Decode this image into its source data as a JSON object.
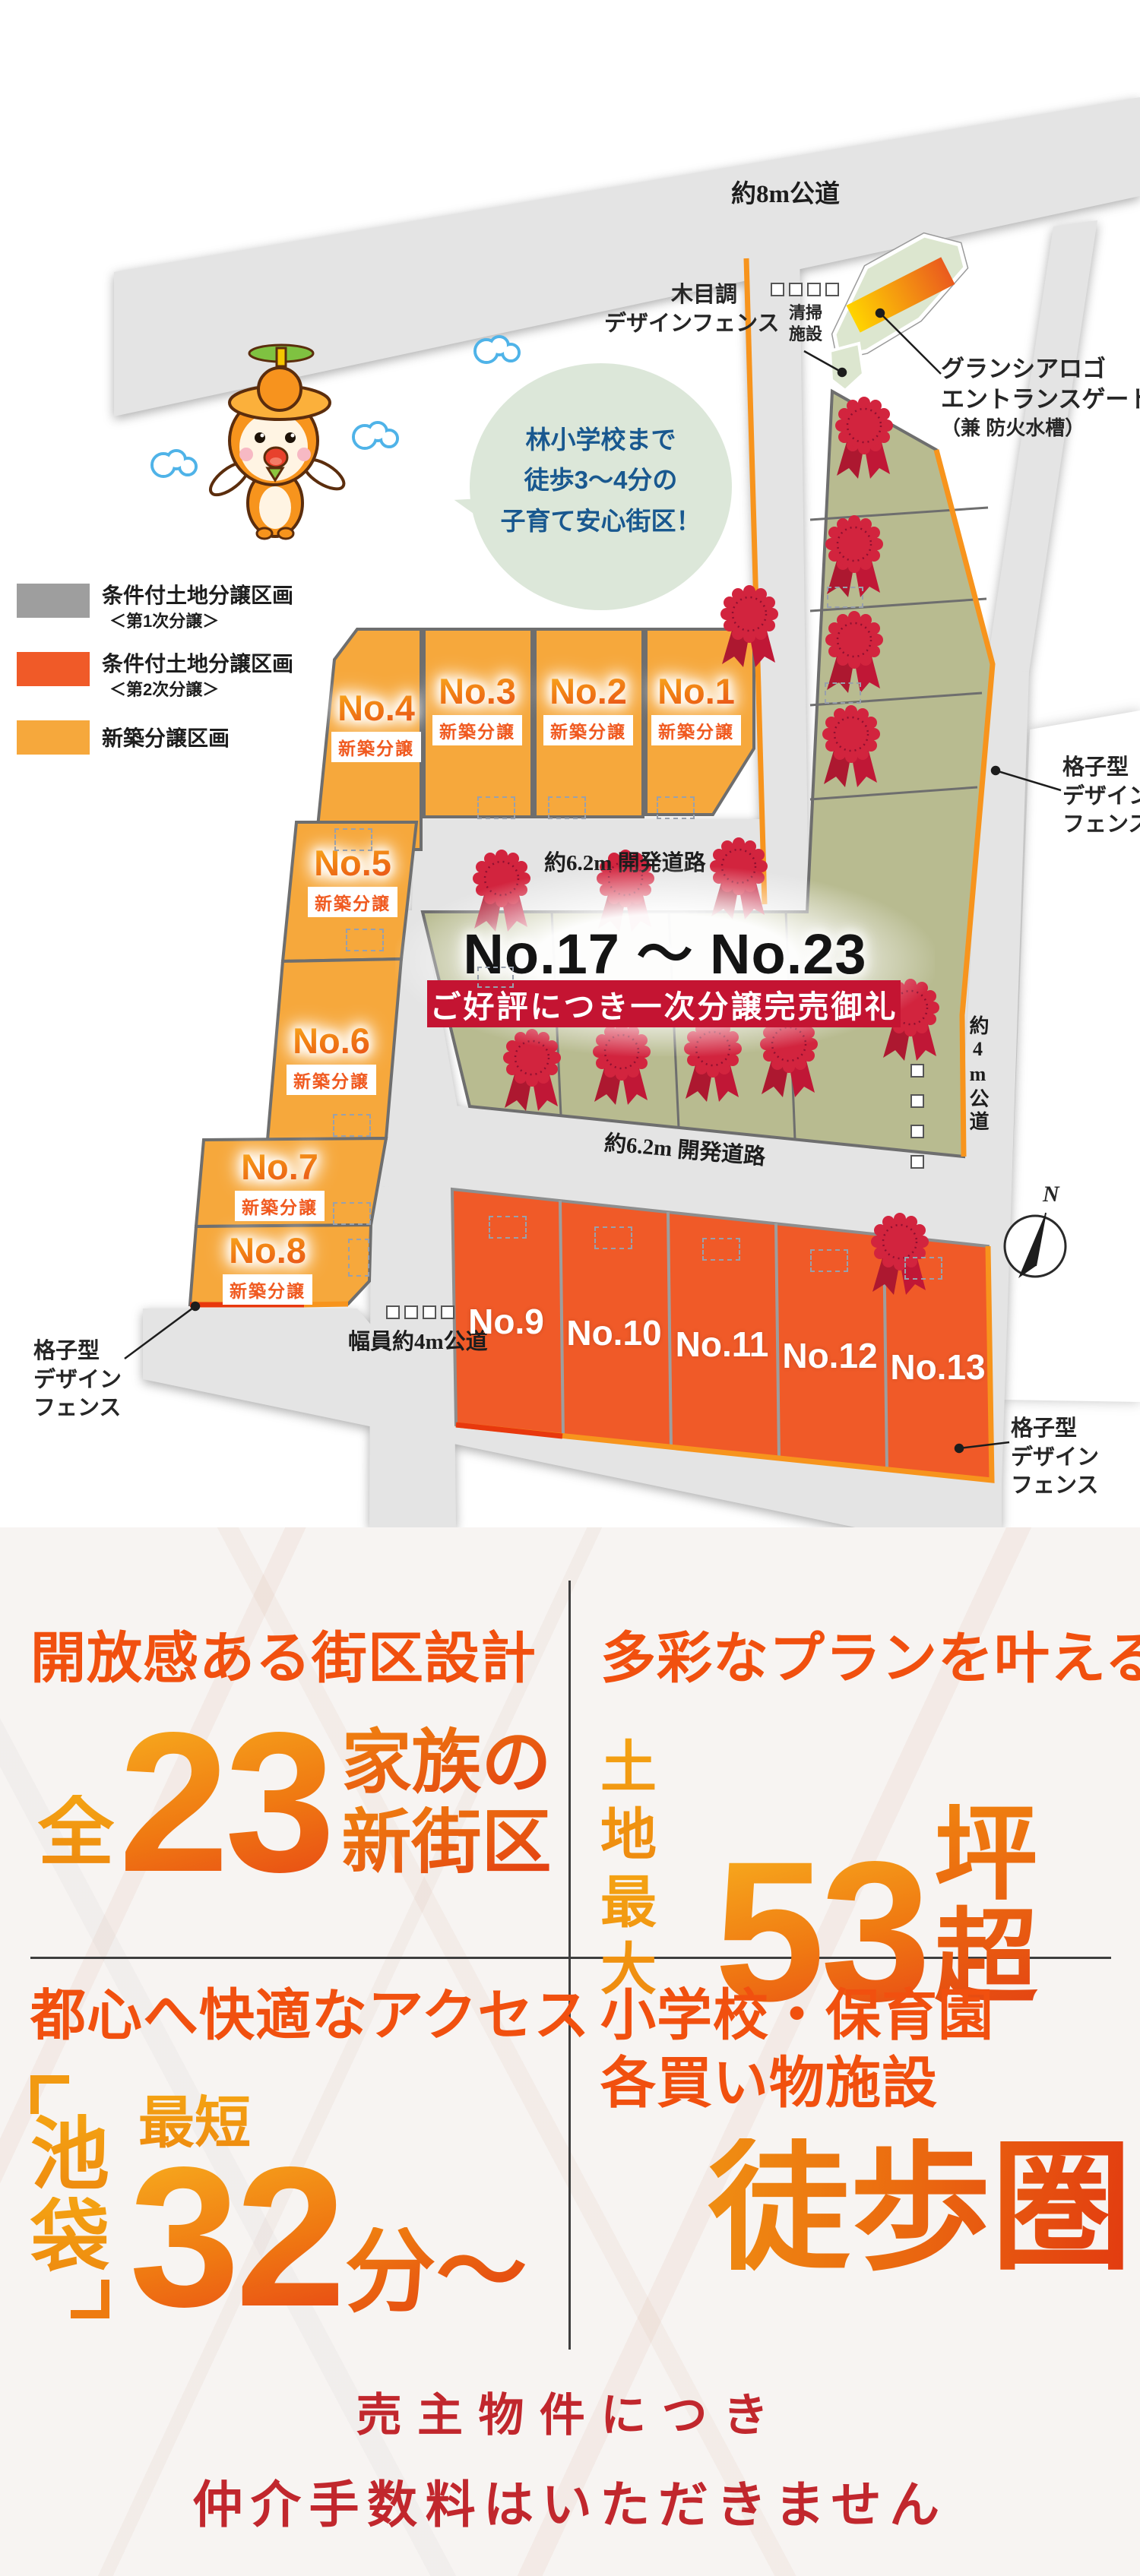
{
  "map": {
    "road_labels": {
      "top": "約8m公道",
      "dev1": "約6.2m 開発道路",
      "dev2": "約6.2m 開発道路",
      "south": "幅員約4m公道",
      "east": "約4m公道"
    },
    "bubble": {
      "line1": "林小学校まで",
      "line2": "徒歩3～4分の",
      "line3": "子育て安心街区！"
    },
    "legend": [
      {
        "label": "条件付土地分譲区画",
        "sub": "＜第1次分譲＞",
        "color": "#9E9E9E"
      },
      {
        "label": "条件付土地分譲区画",
        "sub": "＜第2次分譲＞",
        "color": "#F05A28"
      },
      {
        "label": "新築分譲区画",
        "sub": "",
        "color": "#F6A83C"
      }
    ],
    "annotations": {
      "wood1": "木目調",
      "wood2": "デザインフェンス",
      "cleaning1": "清掃",
      "cleaning2": "施設",
      "gate1": "グランシアロゴ",
      "gate2": "エントランスゲート",
      "gate3": "（兼 防火水槽）",
      "lattice1": "格子型",
      "lattice2": "デザイン",
      "lattice3": "フェンス",
      "compass": "N"
    },
    "sold": {
      "range": "No.17 ～ No.23",
      "banner": "ご好評につき一次分譲完売御礼"
    },
    "lots": [
      {
        "number": "No.1",
        "tag": "新築分譲"
      },
      {
        "number": "No.2",
        "tag": "新築分譲"
      },
      {
        "number": "No.3",
        "tag": "新築分譲"
      },
      {
        "number": "No.4",
        "tag": "新築分譲"
      },
      {
        "number": "No.5",
        "tag": "新築分譲"
      },
      {
        "number": "No.6",
        "tag": "新築分譲"
      },
      {
        "number": "No.7",
        "tag": "新築分譲"
      },
      {
        "number": "No.8",
        "tag": "新築分譲"
      },
      {
        "number": "No.9",
        "tag": ""
      },
      {
        "number": "No.10",
        "tag": ""
      },
      {
        "number": "No.11",
        "tag": ""
      },
      {
        "number": "No.12",
        "tag": ""
      },
      {
        "number": "No.13",
        "tag": ""
      }
    ]
  },
  "features": {
    "q1": {
      "heading": "開放感ある街区設計",
      "prefix": "全",
      "number": "23",
      "suffix1": "家族の",
      "suffix2": "新街区"
    },
    "q2": {
      "heading": "多彩なプランを叶える",
      "prefix1": "土地",
      "prefix2": "最大",
      "number": "53",
      "suffix": "坪超"
    },
    "q3": {
      "heading": "都心へ快適なアクセス",
      "station1": "池",
      "station2": "袋",
      "prefix": "最短",
      "number": "32",
      "suffix": "分～"
    },
    "q4": {
      "heading1": "小学校・保育園",
      "heading2": "各買い物施設",
      "highlight": "徒歩圏"
    }
  },
  "footer": {
    "line1": "売主物件につき",
    "line2": "仲介手数料はいただきません"
  },
  "colors": {
    "lot_amber": "#F6A83C",
    "lot_orange_red": "#F05A28",
    "sold_green": "#B8BB90",
    "banner_red": "#C41432",
    "fence_orange": "#F7941D",
    "footer_red": "#C1272D"
  }
}
